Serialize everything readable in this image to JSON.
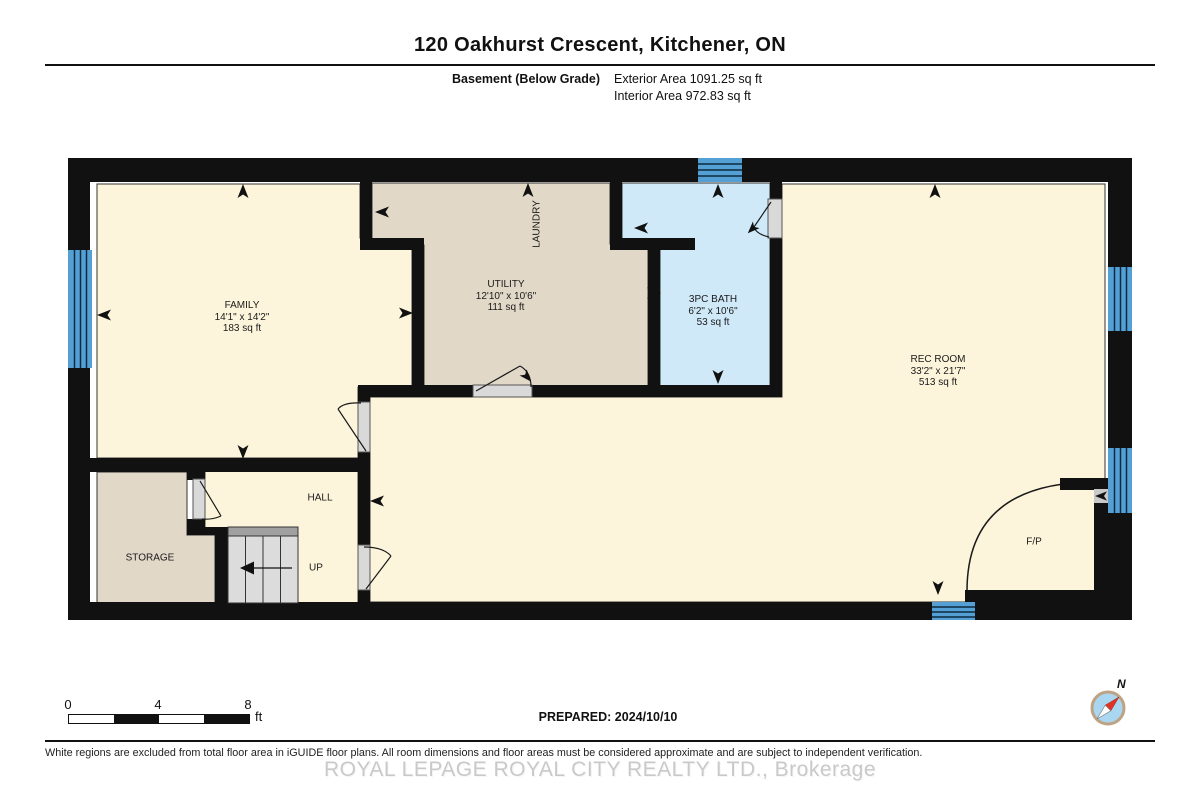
{
  "header": {
    "title": "120 Oakhurst Crescent, Kitchener, ON",
    "floor_label": "Basement (Below Grade)",
    "exterior_area": "Exterior Area 1091.25 sq ft",
    "interior_area": "Interior Area 972.83 sq ft"
  },
  "rooms": {
    "family": {
      "name": "FAMILY",
      "dims": "14'1\" x 14'2\"",
      "area": "183 sq ft"
    },
    "utility": {
      "name": "UTILITY",
      "dims": "12'10\" x 10'6\"",
      "area": "111 sq ft"
    },
    "laundry": {
      "name": "LAUNDRY"
    },
    "bath": {
      "name": "3PC BATH",
      "dims": "6'2\" x 10'6\"",
      "area": "53 sq ft"
    },
    "rec": {
      "name": "REC ROOM",
      "dims": "33'2\" x 21'7\"",
      "area": "513 sq ft"
    },
    "storage": {
      "name": "STORAGE"
    },
    "hall": {
      "name": "HALL"
    },
    "fireplace": {
      "name": "F/P"
    },
    "stairs": {
      "label": "UP"
    }
  },
  "scale_bar": {
    "ticks": [
      "0",
      "4",
      "8"
    ],
    "unit": "ft"
  },
  "footer": {
    "prepared": "PREPARED: 2024/10/10",
    "disclaimer": "White regions are excluded from total floor area in iGUIDE floor plans. All room dimensions and floor areas must be considered approximate and are subject to independent verification.",
    "watermark": "ROYAL LEPAGE ROYAL CITY REALTY LTD., Brokerage"
  },
  "compass": {
    "north_label": "N"
  },
  "colors": {
    "wall": "#111111",
    "room_cream": "#fcf5db",
    "room_tan": "#e2d8c8",
    "room_bath_blue": "#cfe9f8",
    "window_blue": "#549fd3",
    "window_pane_line": "#0d2a40",
    "door_gray": "#d9d9d9",
    "stair_gray": "#dcdcdc",
    "stair_cap_gray": "#a0a0a0",
    "compass_blue": "#a9d6f0",
    "compass_ring": "#bda383",
    "compass_red": "#e03525",
    "watermark_gray": "#c9c9c9"
  }
}
